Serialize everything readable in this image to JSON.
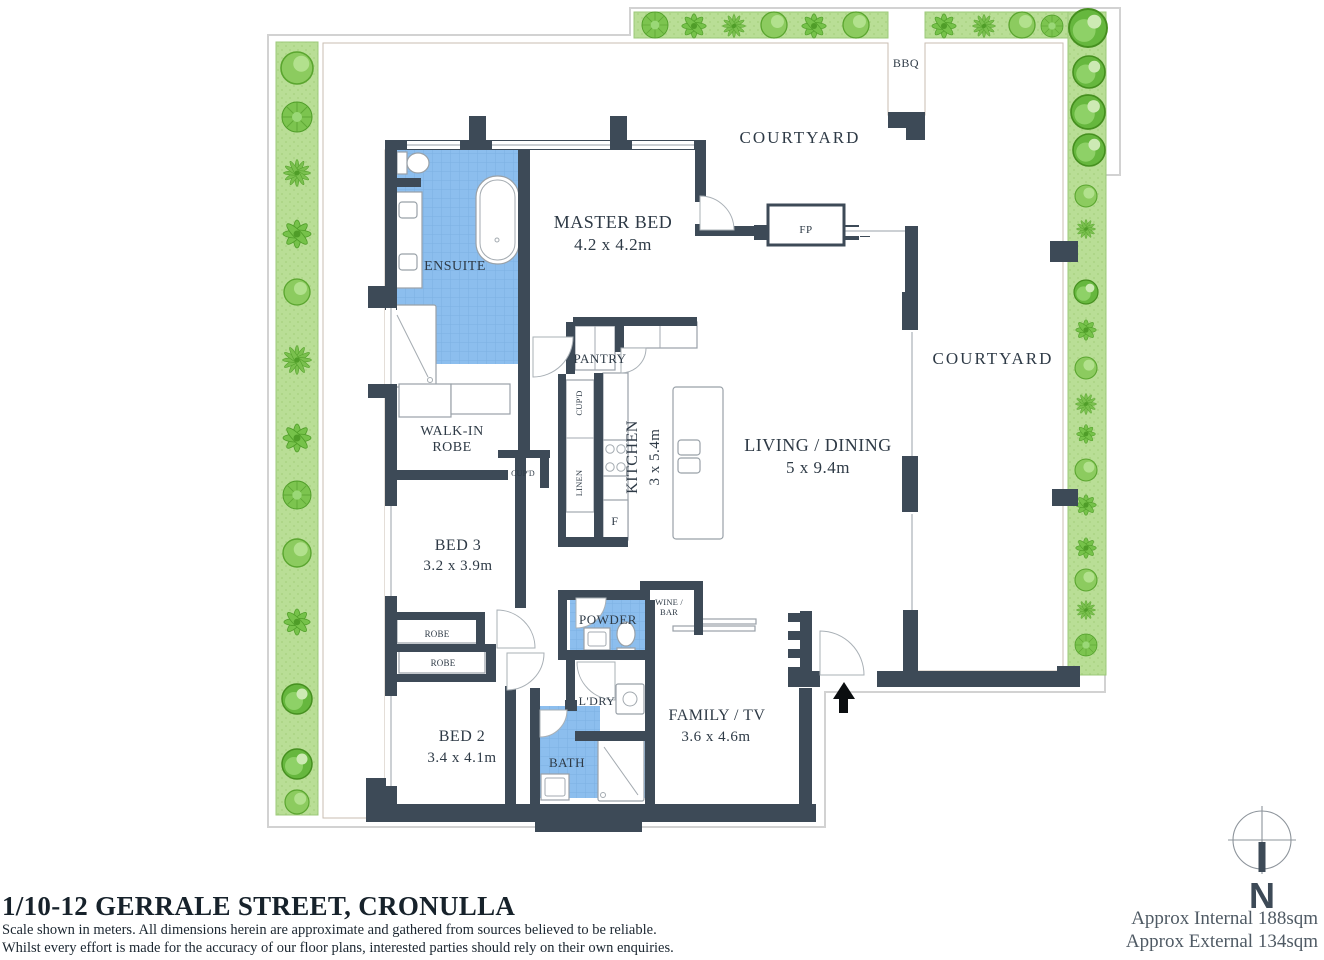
{
  "plan": {
    "courtyard_top": "COURTYARD",
    "courtyard_right": "COURTYARD",
    "bbq": "BBQ",
    "fireplace": "FP",
    "master_bed": {
      "name": "MASTER BED",
      "dims": "4.2 x 4.2m"
    },
    "ensuite": "ENSUITE",
    "walk_in_robe": {
      "line1": "WALK-IN",
      "line2": "ROBE"
    },
    "pantry": "PANTRY",
    "kitchen": {
      "name": "KITCHEN",
      "dims": "3 x 5.4m"
    },
    "cupd_kitchen": "CUP'D",
    "linen": "LINEN",
    "fridge": "F",
    "cupd_hall": "CUP'D",
    "living_dining": {
      "name": "LIVING / DINING",
      "dims": "5 x 9.4m"
    },
    "bed3": {
      "name": "BED 3",
      "dims": "3.2 x 3.9m"
    },
    "robe1": "ROBE",
    "robe2": "ROBE",
    "bed2": {
      "name": "BED 2",
      "dims": "3.4 x 4.1m"
    },
    "powder": "POWDER",
    "wine_bar": {
      "line1": "WINE /",
      "line2": "BAR"
    },
    "laundry": "L'DRY",
    "bath": "BATH",
    "family_tv": {
      "name": "FAMILY / TV",
      "dims": "3.6 x 4.6m"
    }
  },
  "compass": {
    "north_label": "N"
  },
  "footer": {
    "address": "1/10-12 GERRALE STREET, CRONULLA",
    "disclaimer_line1": "Scale shown in meters. All dimensions herein are approximate and gathered from sources believed to be  reliable.",
    "disclaimer_line2": "Whilst every effort is made for the accuracy of our floor plans, interested parties should rely on their own enquiries.",
    "internal_area": "Approx Internal 188sqm",
    "external_area": "Approx External 134sqm"
  },
  "colors": {
    "wall": "#3d4a57",
    "tile_blue": "#8cbeee",
    "garden_green": "#b9de96",
    "deck_tan": "#d9d0c8",
    "text": "#2e3a46"
  }
}
